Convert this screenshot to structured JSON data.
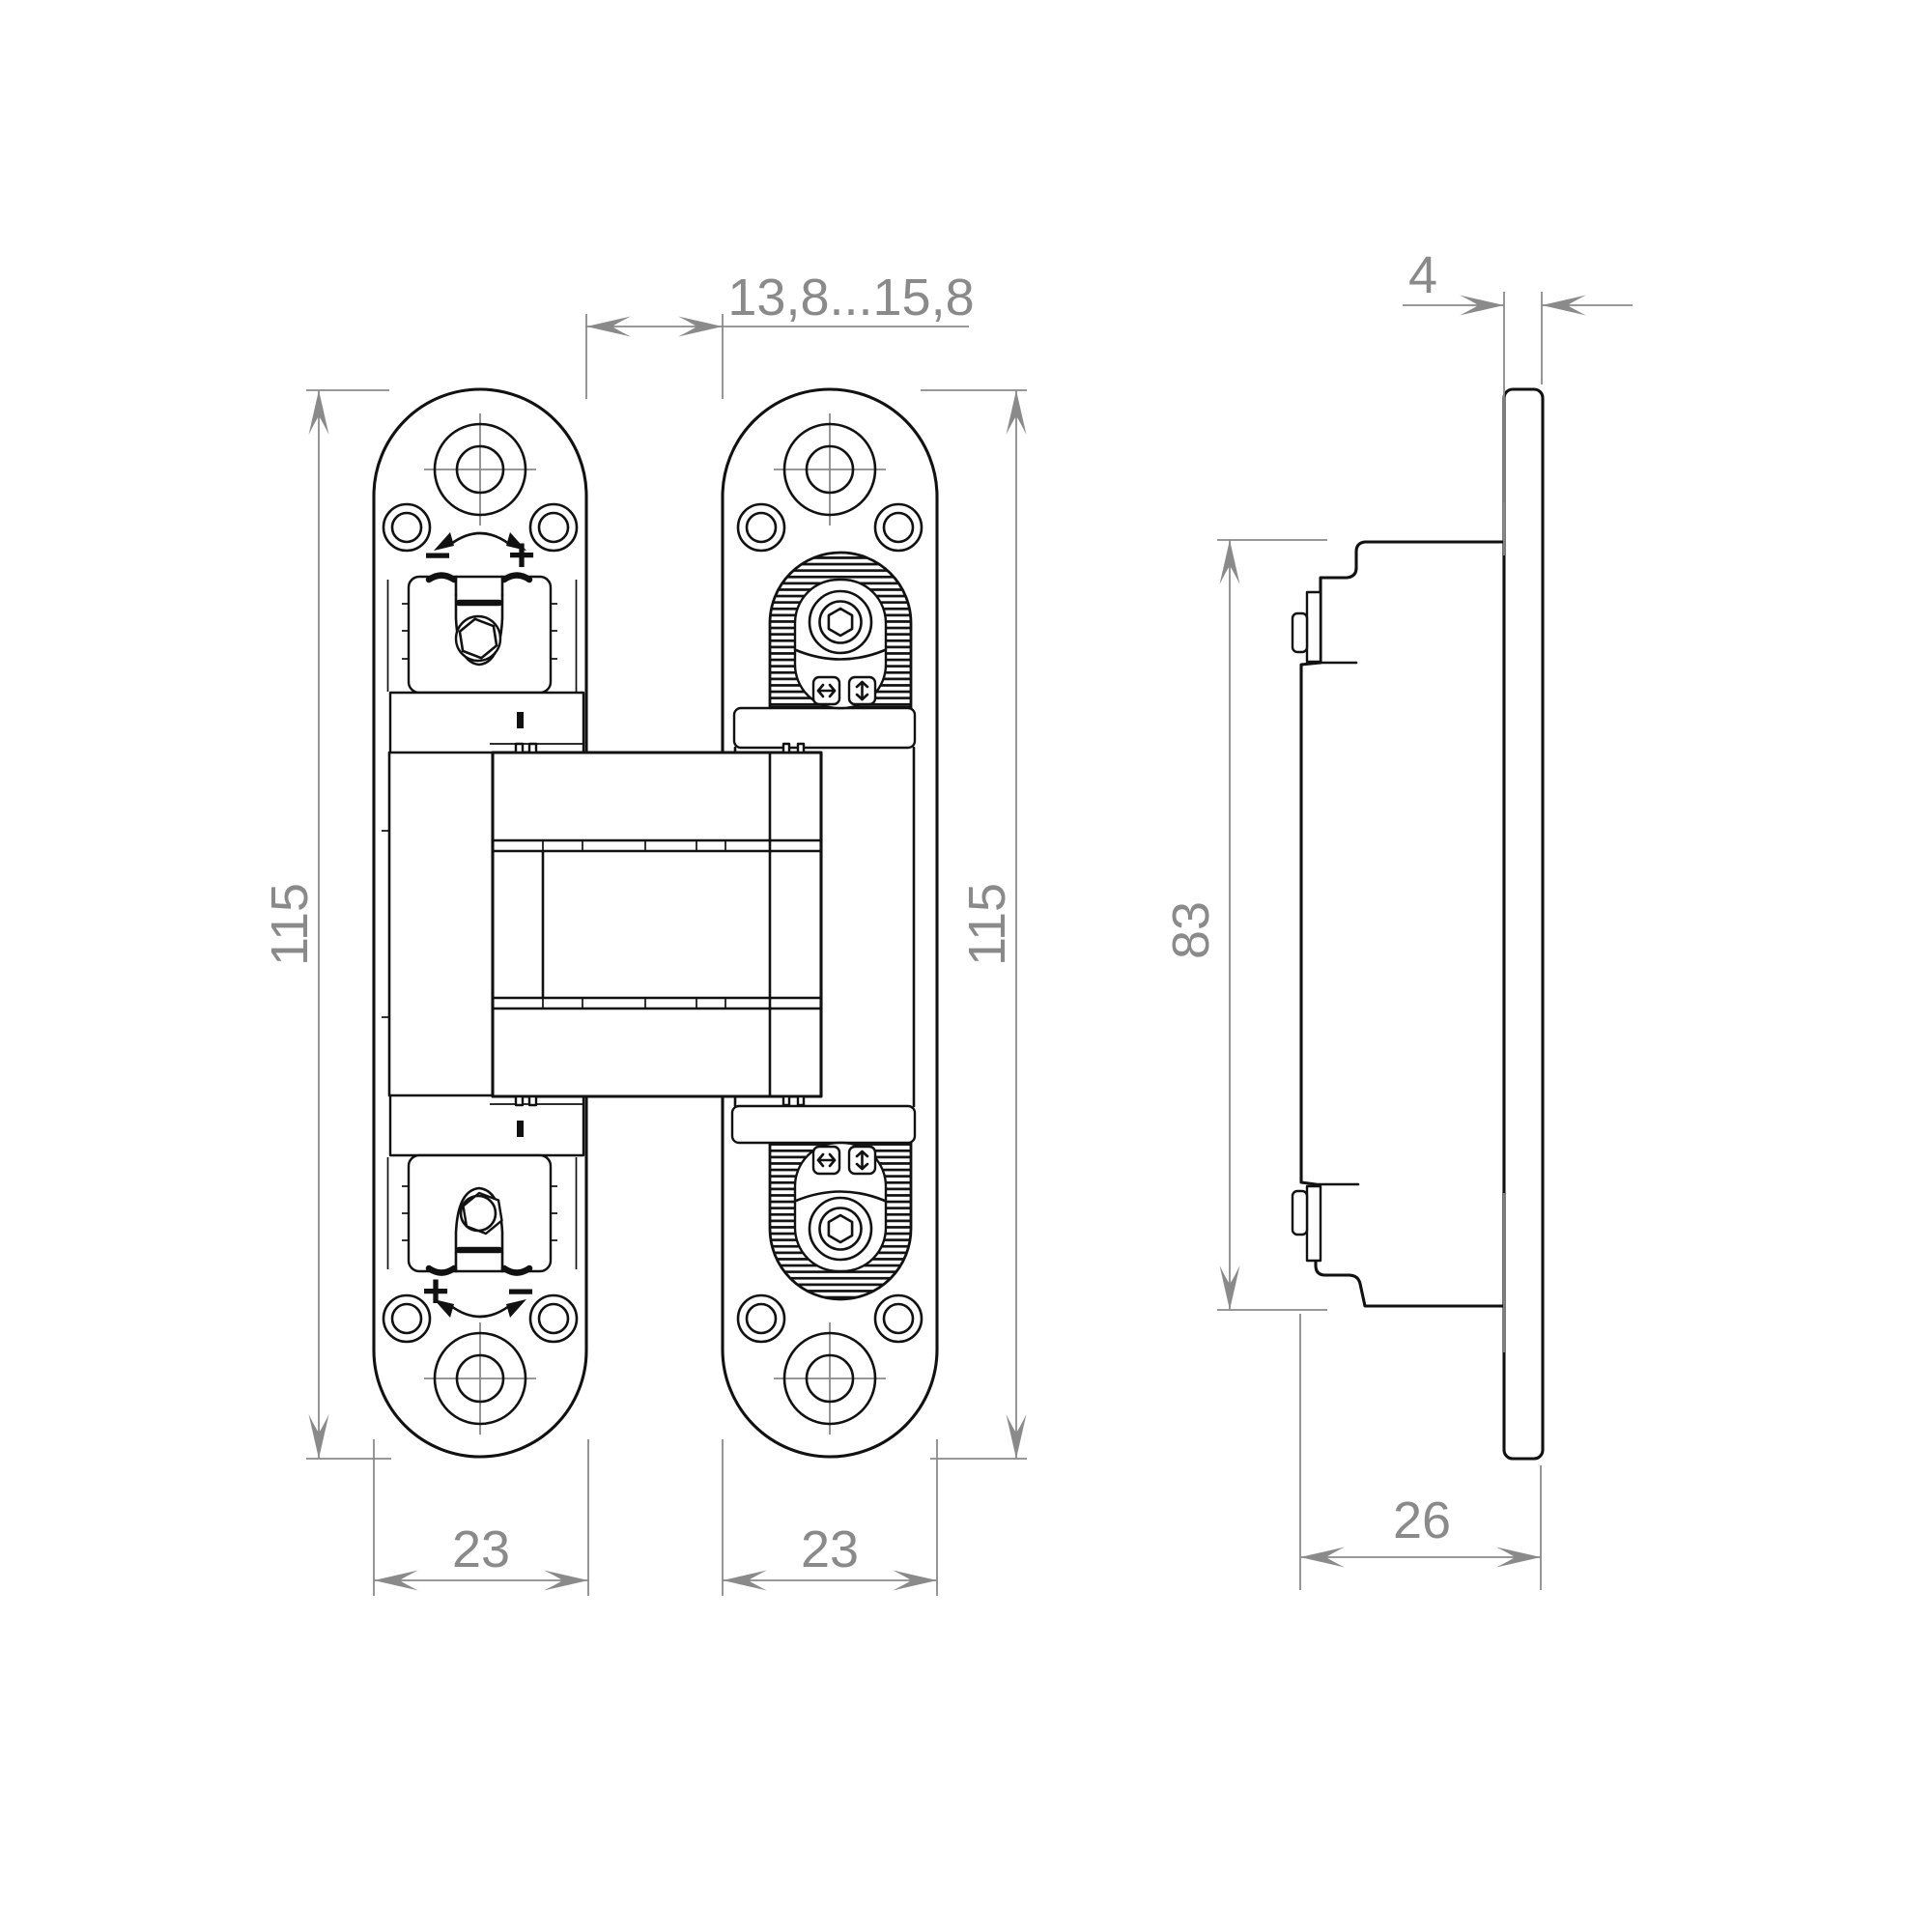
{
  "page": {
    "background": "#ffffff",
    "kind": "technical drawing of concealed door hinge, two views"
  },
  "colors": {
    "line": "#111111",
    "dimension": "#8a8a8a",
    "fill": "#ffffff"
  },
  "front_view": {
    "gap_dim": "13,8...15,8",
    "left_height_dim": "115",
    "right_height_dim": "115",
    "left_width_dim": "23",
    "right_width_dim": "23",
    "top_adjust_minus": "−",
    "top_adjust_plus": "+",
    "bottom_adjust_plus": "+",
    "bottom_adjust_minus": "−"
  },
  "side_view": {
    "thickness_dim": "4",
    "height_dim": "83",
    "depth_dim": "26"
  }
}
